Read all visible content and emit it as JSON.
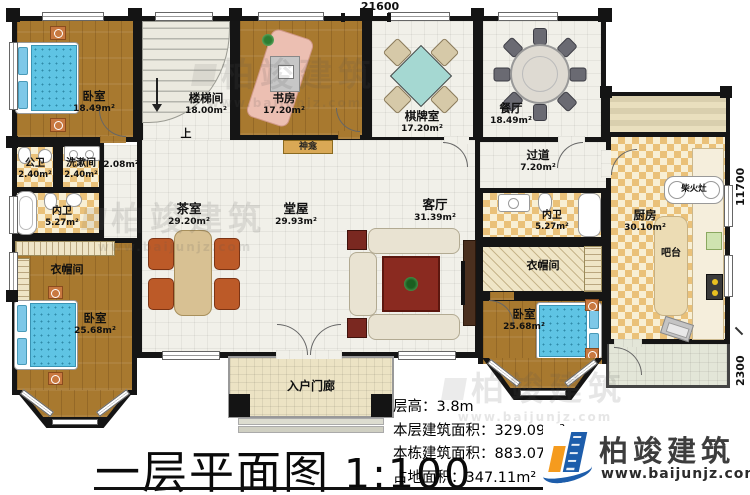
{
  "plan": {
    "dimensions": {
      "top": "21600",
      "right_upper": "11700",
      "right_lower": "2300"
    },
    "rooms": [
      {
        "id": "bedroom-top-left",
        "name": "卧室",
        "area": "18.49m²"
      },
      {
        "id": "stair-hall",
        "name": "楼梯间",
        "area": "18.00m²"
      },
      {
        "id": "study",
        "name": "书房",
        "area": "17.20m²"
      },
      {
        "id": "mahjong-room",
        "name": "棋牌室",
        "area": "17.20m²"
      },
      {
        "id": "dining-room",
        "name": "餐厅",
        "area": "18.49m²"
      },
      {
        "id": "hallway",
        "name": "过道",
        "area": "7.20m²"
      },
      {
        "id": "kitchen",
        "name": "厨房",
        "area": "30.10m²"
      },
      {
        "id": "public-bathroom",
        "name": "公卫",
        "area": "2.40m²"
      },
      {
        "id": "washroom",
        "name": "洗漱间",
        "area": "2.40m²"
      },
      {
        "id": "storage-nook",
        "name": "",
        "area": "2.08m²"
      },
      {
        "id": "ensuite-bathroom-left",
        "name": "内卫",
        "area": "5.27m²"
      },
      {
        "id": "tea-room",
        "name": "茶室",
        "area": "29.20m²"
      },
      {
        "id": "central-hall",
        "name": "堂屋",
        "area": "29.93m²"
      },
      {
        "id": "living-room",
        "name": "客厅",
        "area": "31.39m²"
      },
      {
        "id": "ensuite-bathroom-right",
        "name": "内卫",
        "area": "5.27m²"
      },
      {
        "id": "cloakroom-left",
        "name": "衣帽间",
        "area": ""
      },
      {
        "id": "cloakroom-right",
        "name": "衣帽间",
        "area": ""
      },
      {
        "id": "bedroom-bottom-left",
        "name": "卧室",
        "area": "25.68m²"
      },
      {
        "id": "bedroom-bottom-right",
        "name": "卧室",
        "area": "25.68m²"
      },
      {
        "id": "entry-porch",
        "name": "入户门廊",
        "area": ""
      }
    ],
    "annotations": {
      "stair_up": "上",
      "shrine": "神龛",
      "wood_stove": "柴火灶",
      "bar_counter": "吧台"
    }
  },
  "title_block": {
    "title": "一层平面图",
    "scale": "1:100",
    "stats": [
      {
        "label": "层高：",
        "value": "3.8m"
      },
      {
        "label": "本层建筑面积：",
        "value": "329.09m²"
      },
      {
        "label": "本栋建筑面积：",
        "value": "883.07m²"
      },
      {
        "label": "占地面积：",
        "value": "347.11m²"
      }
    ]
  },
  "branding": {
    "logo_text": "柏竣建筑",
    "logo_url": "www.baijunjz.com",
    "watermark_text": "柏竣建筑",
    "watermark_url": "www.baijunjz.com"
  },
  "colors": {
    "wall": "#151515",
    "wood_floor": "#a8792f",
    "tile_floor": "#f1f0e9",
    "checker_tile": "#eac179",
    "bed_mattress": "#5fc4e4",
    "chair_orange": "#bc5a28",
    "mahjong_table": "#a5d8d2",
    "logo_blue": "#1d5dab",
    "logo_orange": "#f59b1e"
  }
}
